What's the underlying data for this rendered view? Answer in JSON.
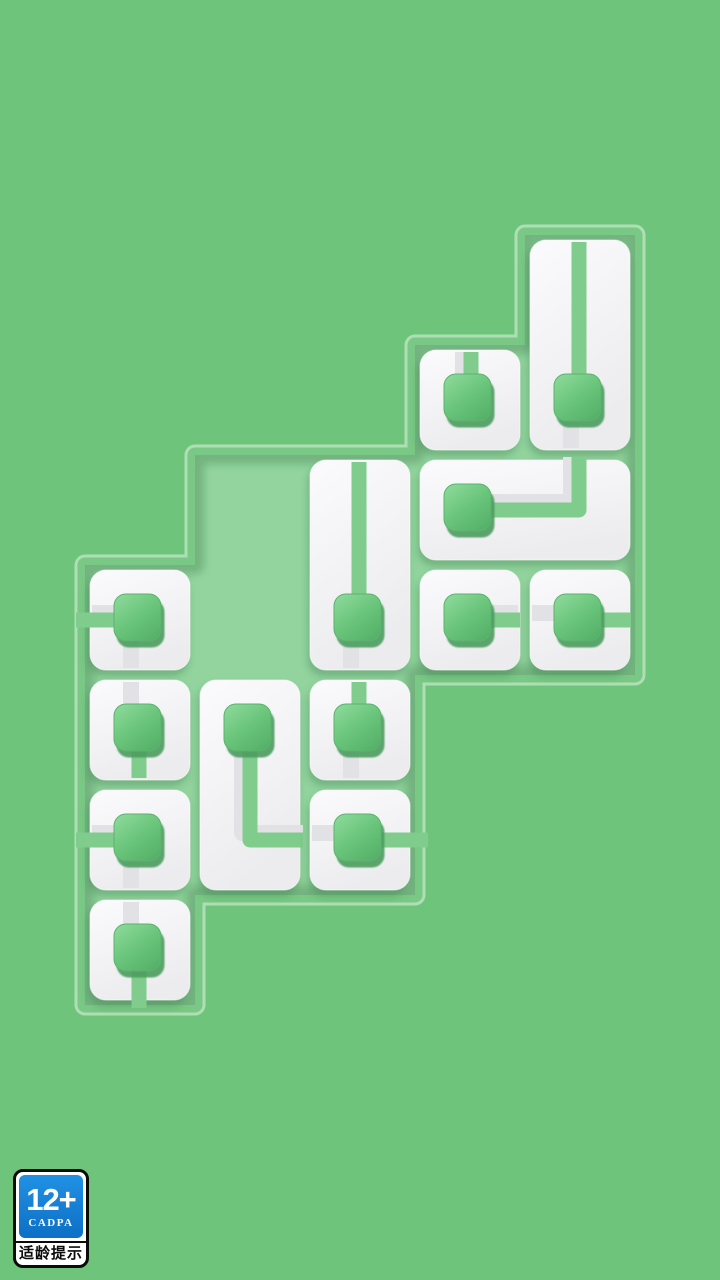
{
  "scene": {
    "width": 720,
    "height": 1280,
    "app_type": "tile-pull puzzle game"
  },
  "colors": {
    "background": "#6ec47b",
    "wall_rim": "#aedfb4",
    "wall_fill": "#7ac885",
    "recess": "#93d49e",
    "recess_shadow": "rgba(32,92,46,0.28)",
    "tile_hi": "#fbfbfd",
    "tile_lo": "#ececef",
    "tile_edge": "rgba(255,255,255,0.55)",
    "tile_shadow": "#2e6e3c",
    "groove": "#e2e2e6",
    "track": "#80cc8d",
    "knob_hi": "#8fdb9d",
    "knob_mid": "#6ac57b",
    "knob_lo": "#57b26a",
    "knob_edge": "#5bb26d",
    "knob_shadow": "#4c9c5f"
  },
  "board": {
    "grid": {
      "origin_x": 85,
      "origin_y": 235,
      "cell": 110,
      "cols": 5,
      "rows": 7,
      "tile_inset": 5,
      "tile_radius": 16,
      "knob_size": 47,
      "knob_radius": 12,
      "groove_width": 16,
      "track_width": 15
    },
    "outline": [
      [
        85,
        565
      ],
      [
        195,
        565
      ],
      [
        195,
        455
      ],
      [
        415,
        455
      ],
      [
        415,
        345
      ],
      [
        525,
        345
      ],
      [
        525,
        235
      ],
      [
        635,
        235
      ],
      [
        635,
        675
      ],
      [
        415,
        675
      ],
      [
        415,
        895
      ],
      [
        195,
        895
      ],
      [
        195,
        1005
      ],
      [
        85,
        1005
      ]
    ],
    "empty_cells": [
      {
        "col": 1,
        "row": 2
      },
      {
        "col": 1,
        "row": 3
      }
    ],
    "tiles": [
      {
        "id": "tile-c4-r0-tall",
        "col": 4,
        "row": 0,
        "w": 1,
        "h": 2,
        "knob": {
          "cx": 578,
          "cy": 398
        },
        "greens": [
          [
            [
              579,
              242
            ],
            [
              579,
              400
            ]
          ]
        ],
        "grooves": [
          [
            [
              571,
              400
            ],
            [
              571,
              448
            ]
          ]
        ]
      },
      {
        "id": "tile-c3-r1",
        "col": 3,
        "row": 1,
        "w": 1,
        "h": 1,
        "knob": {
          "cx": 468,
          "cy": 398
        },
        "greens": [
          [
            [
              471,
              352
            ],
            [
              471,
              400
            ]
          ]
        ],
        "grooves": [
          [
            [
              463,
              352
            ],
            [
              463,
              398
            ]
          ]
        ]
      },
      {
        "id": "tile-c3c4-r2-wide",
        "col": 3,
        "row": 2,
        "w": 2,
        "h": 1,
        "knob": {
          "cx": 468,
          "cy": 508
        },
        "greens": [
          [
            [
              470,
              510
            ],
            [
              579,
              510
            ],
            [
              579,
              457
            ]
          ]
        ],
        "grooves": [
          [
            [
              470,
              502
            ],
            [
              571,
              502
            ],
            [
              571,
              457
            ]
          ]
        ]
      },
      {
        "id": "tile-c2-r2-tall",
        "col": 2,
        "row": 2,
        "w": 1,
        "h": 2,
        "knob": {
          "cx": 358,
          "cy": 618
        },
        "greens": [
          [
            [
              359,
              462
            ],
            [
              359,
              620
            ]
          ]
        ],
        "grooves": [
          [
            [
              351,
              620
            ],
            [
              351,
              668
            ]
          ]
        ]
      },
      {
        "id": "tile-c0-r3",
        "col": 0,
        "row": 3,
        "w": 1,
        "h": 1,
        "knob": {
          "cx": 138,
          "cy": 618
        },
        "greens": [
          [
            [
              76,
              620
            ],
            [
              138,
              620
            ]
          ]
        ],
        "grooves": [
          [
            [
              92,
              613
            ],
            [
              134,
              613
            ]
          ],
          [
            [
              131,
              620
            ],
            [
              131,
              668
            ]
          ]
        ]
      },
      {
        "id": "tile-c3-r3",
        "col": 3,
        "row": 3,
        "w": 1,
        "h": 1,
        "knob": {
          "cx": 468,
          "cy": 618
        },
        "greens": [
          [
            [
              470,
              620
            ],
            [
              520,
              620
            ]
          ]
        ],
        "grooves": [
          [
            [
              470,
              613
            ],
            [
              518,
              613
            ]
          ]
        ]
      },
      {
        "id": "tile-c4-r3",
        "col": 4,
        "row": 3,
        "w": 1,
        "h": 1,
        "knob": {
          "cx": 578,
          "cy": 618
        },
        "greens": [
          [
            [
              580,
              620
            ],
            [
              631,
              620
            ]
          ]
        ],
        "grooves": [
          [
            [
              532,
              613
            ],
            [
              576,
              613
            ]
          ]
        ]
      },
      {
        "id": "tile-c1-r4-tall",
        "col": 1,
        "row": 4,
        "w": 1,
        "h": 2,
        "knob": {
          "cx": 248,
          "cy": 728
        },
        "greens": [
          [
            [
              250,
              730
            ],
            [
              250,
              840
            ],
            [
              303,
              840
            ]
          ]
        ],
        "grooves": [
          [
            [
              242,
              730
            ],
            [
              242,
              833
            ],
            [
              303,
              833
            ]
          ]
        ]
      },
      {
        "id": "tile-c2-r4",
        "col": 2,
        "row": 4,
        "w": 1,
        "h": 1,
        "knob": {
          "cx": 358,
          "cy": 728
        },
        "greens": [
          [
            [
              359,
              682
            ],
            [
              359,
              730
            ]
          ]
        ],
        "grooves": [
          [
            [
              351,
              730
            ],
            [
              351,
              778
            ]
          ]
        ]
      },
      {
        "id": "tile-c0-r4",
        "col": 0,
        "row": 4,
        "w": 1,
        "h": 1,
        "knob": {
          "cx": 138,
          "cy": 728
        },
        "greens": [
          [
            [
              139,
              730
            ],
            [
              139,
              778
            ]
          ]
        ],
        "grooves": [
          [
            [
              131,
              682
            ],
            [
              131,
              728
            ]
          ]
        ]
      },
      {
        "id": "tile-c2-r5",
        "col": 2,
        "row": 5,
        "w": 1,
        "h": 1,
        "knob": {
          "cx": 358,
          "cy": 838
        },
        "greens": [
          [
            [
              359,
              840
            ],
            [
              428,
              840
            ]
          ]
        ],
        "grooves": [
          [
            [
              312,
              833
            ],
            [
              356,
              833
            ]
          ]
        ]
      },
      {
        "id": "tile-c0-r5",
        "col": 0,
        "row": 5,
        "w": 1,
        "h": 1,
        "knob": {
          "cx": 138,
          "cy": 838
        },
        "greens": [
          [
            [
              76,
              840
            ],
            [
              138,
              840
            ]
          ]
        ],
        "grooves": [
          [
            [
              92,
              833
            ],
            [
              134,
              833
            ]
          ],
          [
            [
              131,
              840
            ],
            [
              131,
              888
            ]
          ]
        ]
      },
      {
        "id": "tile-c0-r6",
        "col": 0,
        "row": 6,
        "w": 1,
        "h": 1,
        "knob": {
          "cx": 138,
          "cy": 948
        },
        "greens": [
          [
            [
              139,
              950
            ],
            [
              139,
              1008
            ]
          ]
        ],
        "grooves": [
          [
            [
              131,
              902
            ],
            [
              131,
              948
            ]
          ]
        ]
      }
    ]
  },
  "badge": {
    "age": "12+",
    "org": "CADPA",
    "caption": "适龄提示",
    "blue_top": "#2191e3",
    "blue_bottom": "#0d6fc6",
    "border_color": "#0b0b0b"
  }
}
